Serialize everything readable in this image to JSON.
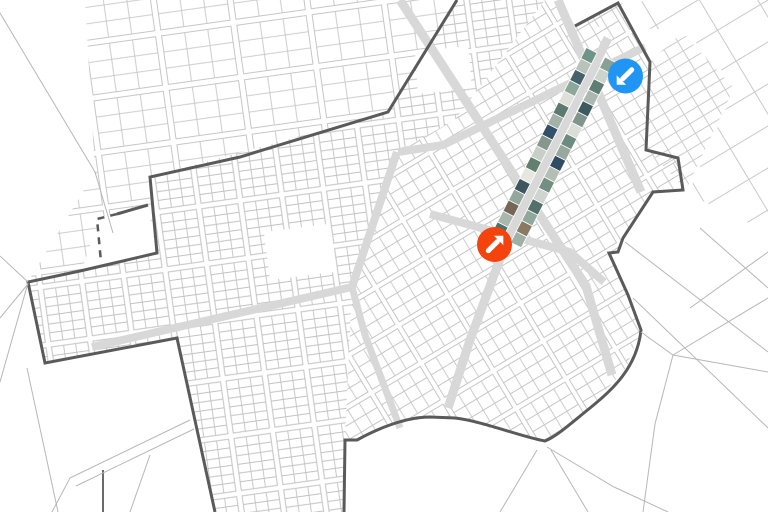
{
  "map": {
    "background": "#ffffff",
    "road_color": "#d8d8d8",
    "boundary_color": "#5a5a5a",
    "outside_line_color": "#b7b7b7",
    "zones": [
      {
        "id": "sparse-northwest",
        "rot": -8,
        "line": "#c6c6c6",
        "tile": {
          "w": 76,
          "h": 55,
          "street": 6,
          "cols": 3,
          "rows": 3
        },
        "clip": "85,0 457,0 388,112 240,157 150,177 157,253 80,271 28,282 95,172"
      },
      {
        "id": "dense-west",
        "rot": -8,
        "line": "#c2c2c2",
        "tile": {
          "w": 42,
          "h": 58,
          "street": 5.5,
          "cols": 3,
          "rows": 6
        },
        "clip": "150,177 388,112 457,0 545,0 455,120 400,150 352,287 345,440 343,512 215,512 177,338 45,363 28,282 80,271 157,253"
      },
      {
        "id": "central-rotated",
        "rot": -31,
        "line": "#c6c6c6",
        "tile": {
          "w": 58,
          "h": 44,
          "street": 5,
          "cols": 4,
          "rows": 3
        },
        "clip": "545,0 560,0 575,26 618,3 650,62 646,150 678,158 683,190 653,192 623,238 618,252 609,253 628,295 641,330 626,368 590,408 545,441 505,432 455,418 430,417 390,426 357,440 345,440 352,287 400,150 455,120"
      },
      {
        "id": "small-grid-northeast",
        "rot": -31,
        "line": "#cccccc",
        "tile": {
          "w": 16,
          "h": 11,
          "street": 0
        },
        "clip": "650,62 682,32 734,88 686,190 648,150"
      },
      {
        "id": "sparse-northeast",
        "rot": -31,
        "line": "#c9c9c9",
        "tile": {
          "w": 50,
          "h": 36,
          "street": 0
        },
        "clip": "577,26 618,4 652,0 768,0 768,232 688,194 736,86 684,30"
      }
    ],
    "white_patches": [
      {
        "id": "excluded-block",
        "pts": "100,217 148,206 156,252 82,269"
      },
      {
        "id": "open-block-west",
        "pts": "264,232 328,224 334,272 270,280"
      },
      {
        "id": "open-block-center",
        "pts": "415,52 468,46 472,88 418,94"
      }
    ],
    "roads": [
      {
        "id": "avenue-nw-se-1",
        "d": "M400,0 L586,286 L612,375",
        "w": 9
      },
      {
        "id": "avenue-nw-se-2",
        "d": "M558,0 L641,192",
        "w": 9
      },
      {
        "id": "main-street-strip",
        "d": "M608,38 L507,240 L470,340 L448,408",
        "w": 9
      },
      {
        "id": "cross-street-north",
        "d": "M645,47 L443,145 L398,152",
        "w": 8
      },
      {
        "id": "cross-street-south",
        "d": "M430,214 L570,252 L604,282",
        "w": 8
      },
      {
        "id": "west-connector",
        "d": "M397,152 L352,287 L92,347",
        "w": 8
      },
      {
        "id": "south-connector",
        "d": "M352,287 L365,335 L400,428",
        "w": 7
      }
    ],
    "boundary": {
      "solid": [
        "M457,0 L388,112 L240,157 L150,177 L157,253 L80,271 L28,282 L45,363 L177,338 L215,512",
        "M575,26 L618,3 L650,62 L646,150 L678,158 L683,190 L653,192 L623,238 L618,252 L609,253 L628,295 L641,330 C637,368 612,390 590,408 C570,424 557,436 545,441 C522,437 482,421 455,418 L430,417 C405,417 377,429 357,440 L345,440 L344,512",
        "M148,205 L117,214"
      ],
      "dashed": [
        "M117,214 L97,219 L101,262"
      ],
      "fragments": [
        "M103,470 L103,512"
      ],
      "width": 3,
      "dash_pattern": "7 6"
    },
    "outside_lines": [
      "M0,13 L95,172 L113,233",
      "M0,256 L28,282",
      "M0,318 L28,284",
      "M28,283 L0,382",
      "M27,368 L58,512",
      "M190,420 L70,478",
      "M194,429 L76,486",
      "M70,478 L52,512",
      "M150,455 L130,512",
      "M625,242 L768,352",
      "M633,298 L768,428",
      "M768,252 L690,308",
      "M700,228 L768,288",
      "M641,332 L673,355 L768,372",
      "M673,355 L768,298",
      "M673,355 L655,424 L643,512",
      "M547,447 L614,487 L668,512",
      "M551,450 L588,512",
      "M537,450 L500,512"
    ],
    "imagery_strip": {
      "origin": [
        601,
        55
      ],
      "angle_deg": 117,
      "length": 208,
      "segments": 17,
      "band_width": 12,
      "band_offset": 4.5,
      "left_band_colors": [
        "#87a196",
        "#cdd4cc",
        "#5e7d74",
        "#aab8af",
        "#3e5a61",
        "#80958b",
        "#d9ded6",
        "#6d8c81",
        "#97a89d",
        "#304b63",
        "#b4beb5",
        "#738e83",
        "#cfd5ce",
        "#53716a",
        "#90a89c",
        "#8a7a64",
        "#9fb1a6"
      ],
      "right_band_colors": [
        "#6f9488",
        "#b9c3ba",
        "#46616a",
        "#8ea79b",
        "#dde0d8",
        "#5d7a70",
        "#a3b2a8",
        "#33506a",
        "#86988e",
        "#c8cfc7",
        "#62806f",
        "#e6e7e1",
        "#3f5560",
        "#94a79d",
        "#756758",
        "#a9b7ae",
        "#51706a"
      ]
    },
    "markers": [
      {
        "id": "north-entry",
        "color": "#2095f3",
        "x": 625.5,
        "y": 76,
        "r": 17.5,
        "arrow": "down-left"
      },
      {
        "id": "center-focus",
        "color": "#f5430d",
        "x": 494.5,
        "y": 244.5,
        "r": 17.5,
        "arrow": "up-right"
      }
    ]
  }
}
